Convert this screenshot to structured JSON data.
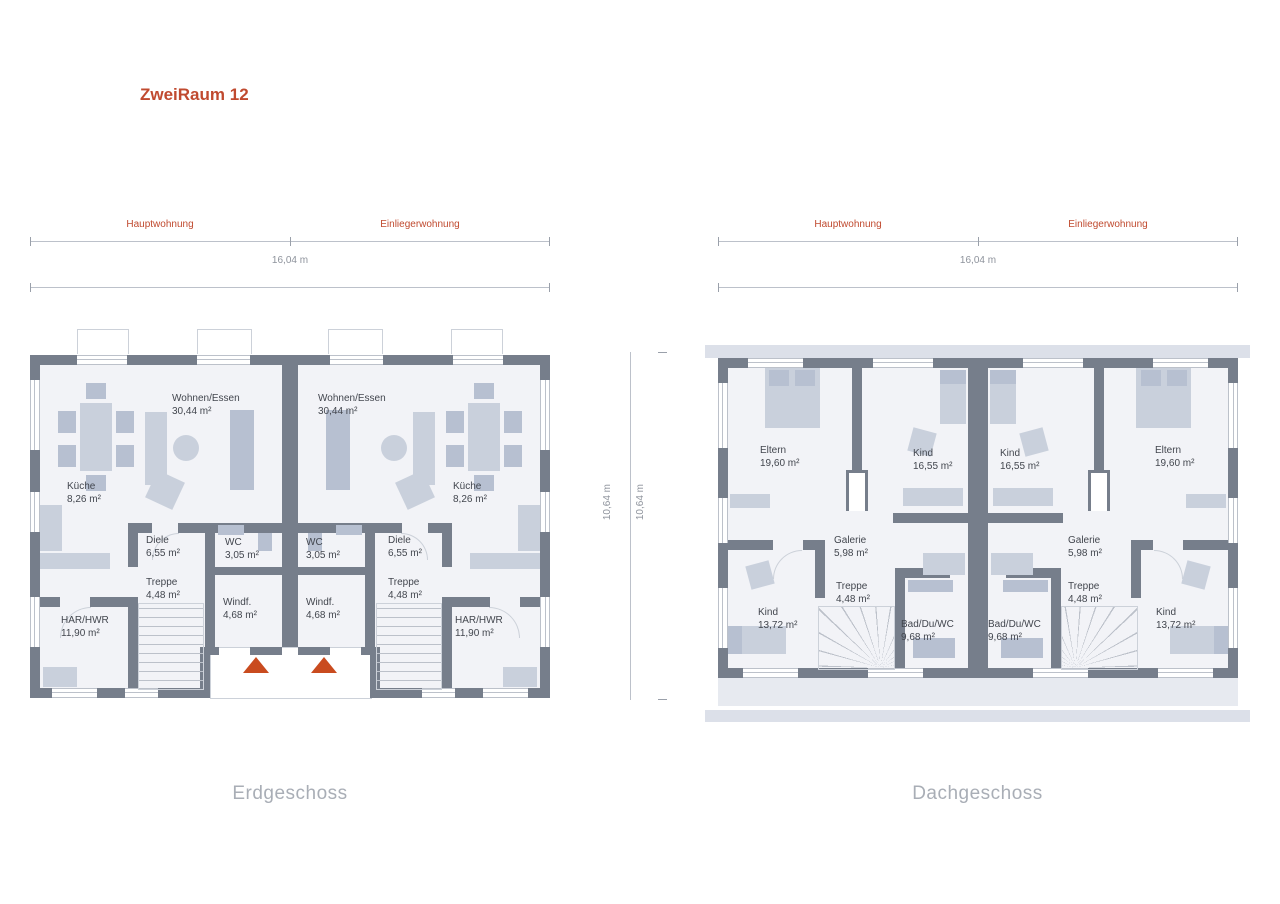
{
  "title": "ZweiRaum 12",
  "captions": {
    "eg": "Erdgeschoss",
    "dg": "Dachgeschoss"
  },
  "dimensions": {
    "left_section": "Hauptwohnung",
    "right_section": "Einliegerwohnung",
    "total_width": "16,04 m",
    "total_depth_left": "10,64 m",
    "total_depth_right": "10,64 m"
  },
  "rooms": {
    "eg": {
      "wohnen": {
        "name": "Wohnen/Essen",
        "area": "30,44 m²"
      },
      "kueche": {
        "name": "Küche",
        "area": "8,26 m²"
      },
      "diele": {
        "name": "Diele",
        "area": "6,55 m²"
      },
      "wc": {
        "name": "WC",
        "area": "3,05 m²"
      },
      "treppe": {
        "name": "Treppe",
        "area": "4,48 m²"
      },
      "windfang": {
        "name": "Windf.",
        "area": "4,68 m²"
      },
      "har": {
        "name": "HAR/HWR",
        "area": "11,90 m²"
      }
    },
    "dg": {
      "eltern": {
        "name": "Eltern",
        "area": "19,60 m²"
      },
      "kind_gross": {
        "name": "Kind",
        "area": "16,55 m²"
      },
      "galerie": {
        "name": "Galerie",
        "area": "5,98 m²"
      },
      "treppe": {
        "name": "Treppe",
        "area": "4,48 m²"
      },
      "kind_klein": {
        "name": "Kind",
        "area": "13,72 m²"
      },
      "bad": {
        "name": "Bad/Du/WC",
        "area": "9,68 m²"
      }
    }
  },
  "colors": {
    "accent": "#c04a2f",
    "arrow": "#c94b1f",
    "wall": "#767e8b",
    "floor": "#f2f3f7",
    "furniture": "#c9d0dc",
    "furniture2": "#b7c0d1",
    "line": "#bcc1ca",
    "soft": "#ccd1d9",
    "dimtext": "#8e939c",
    "dimtick": "#9aa0aa",
    "caption": "#a9aeb6",
    "ink": "#42464e",
    "band": "#dce0e9",
    "strip": "#e7eaf0"
  }
}
